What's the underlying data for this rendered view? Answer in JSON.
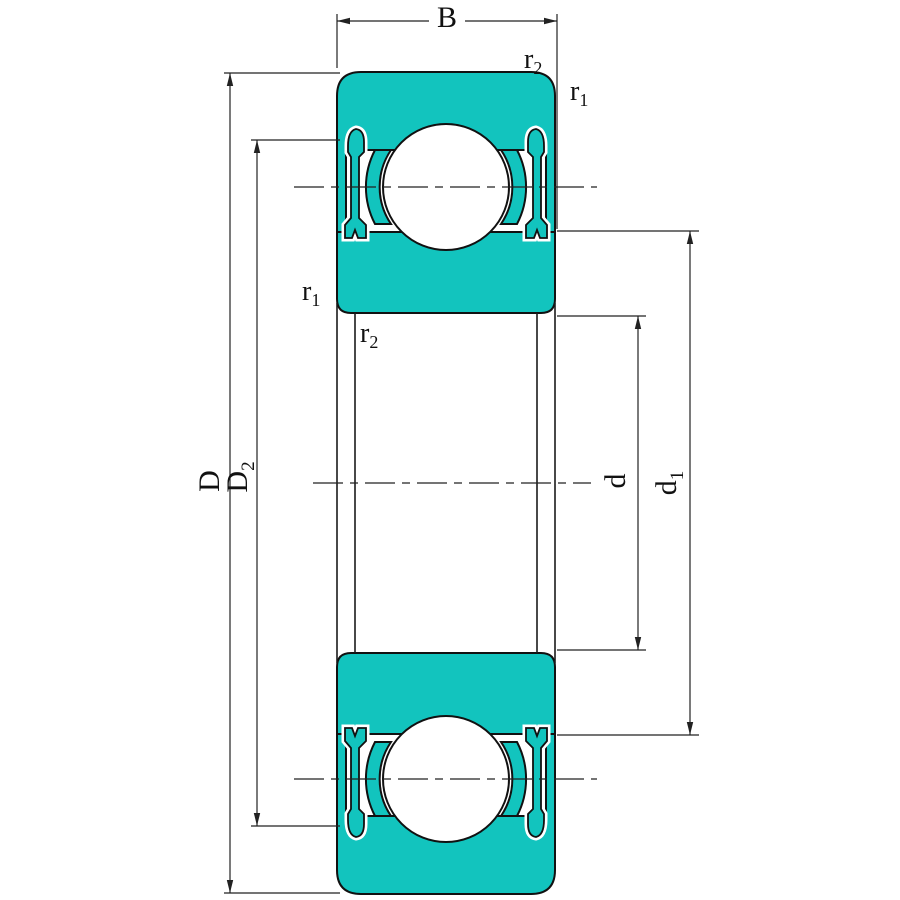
{
  "diagram": {
    "type": "ball-bearing-cross-section-drawing",
    "labels": {
      "width": {
        "main": "B",
        "sub": ""
      },
      "outer_diameter": {
        "main": "D",
        "sub": ""
      },
      "recess_diameter": {
        "main": "D",
        "sub": "2"
      },
      "bore_diameter": {
        "main": "d",
        "sub": ""
      },
      "shoulder_diameter": {
        "main": "d",
        "sub": "1"
      },
      "chamfer_r1": {
        "main": "r",
        "sub": "1"
      },
      "chamfer_r2": {
        "main": "r",
        "sub": "2"
      }
    },
    "colors": {
      "body": "#12C4BE",
      "outline": "#111111",
      "dimension_lines": "#222222",
      "background": "#FFFFFF"
    }
  }
}
